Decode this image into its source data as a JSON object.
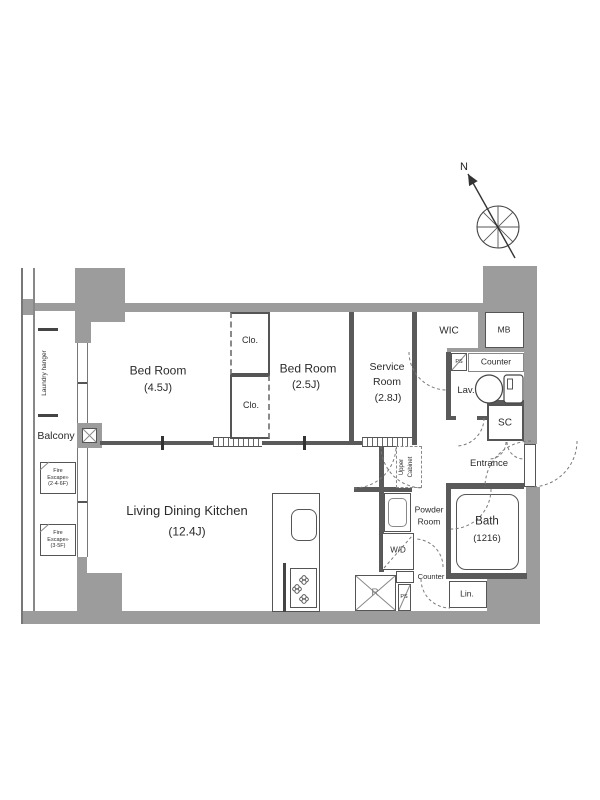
{
  "compass": {
    "north_label": "N"
  },
  "exterior": {
    "balcony_label": "Balcony",
    "laundry_hanger_label": "Laundry hanger",
    "fire_escape_upper": {
      "l1": "Fire",
      "l2": "Escape»",
      "l3": "(2·4·6F)"
    },
    "fire_escape_lower": {
      "l1": "Fire",
      "l2": "Escape»",
      "l3": "(3·5F)"
    }
  },
  "rooms": {
    "bedroom_west": {
      "name": "Bed Room",
      "size": "(4.5J)"
    },
    "bedroom_center": {
      "name": "Bed Room",
      "size": "(2.5J)"
    },
    "service_room": {
      "l1": "Service",
      "l2": "Room",
      "size": "(2.8J)"
    },
    "ldk": {
      "name": "Living Dining Kitchen",
      "size": "(12.4J)"
    },
    "closet_upper": {
      "label": "Clo."
    },
    "closet_lower": {
      "label": "Clo."
    },
    "wic": {
      "label": "WIC"
    },
    "meter_box": {
      "label": "MB"
    },
    "lavatory": {
      "counter": "Counter",
      "label": "Lav.",
      "pipe_space": "PS"
    },
    "shoe_closet": {
      "label": "SC"
    },
    "entrance": {
      "label": "Entrance"
    },
    "upper_cabinet": {
      "l1": "Upper",
      "l2": "Cabinet"
    },
    "powder_room": {
      "l1": "Powder",
      "l2": "Room",
      "washer_dryer": "W/D"
    },
    "bath": {
      "name": "Bath",
      "size": "(1216)"
    },
    "kitchen_lower": {
      "counter": "Counter",
      "refrigerator": "R",
      "pipe_space": "PS",
      "linen": "Lin."
    }
  }
}
